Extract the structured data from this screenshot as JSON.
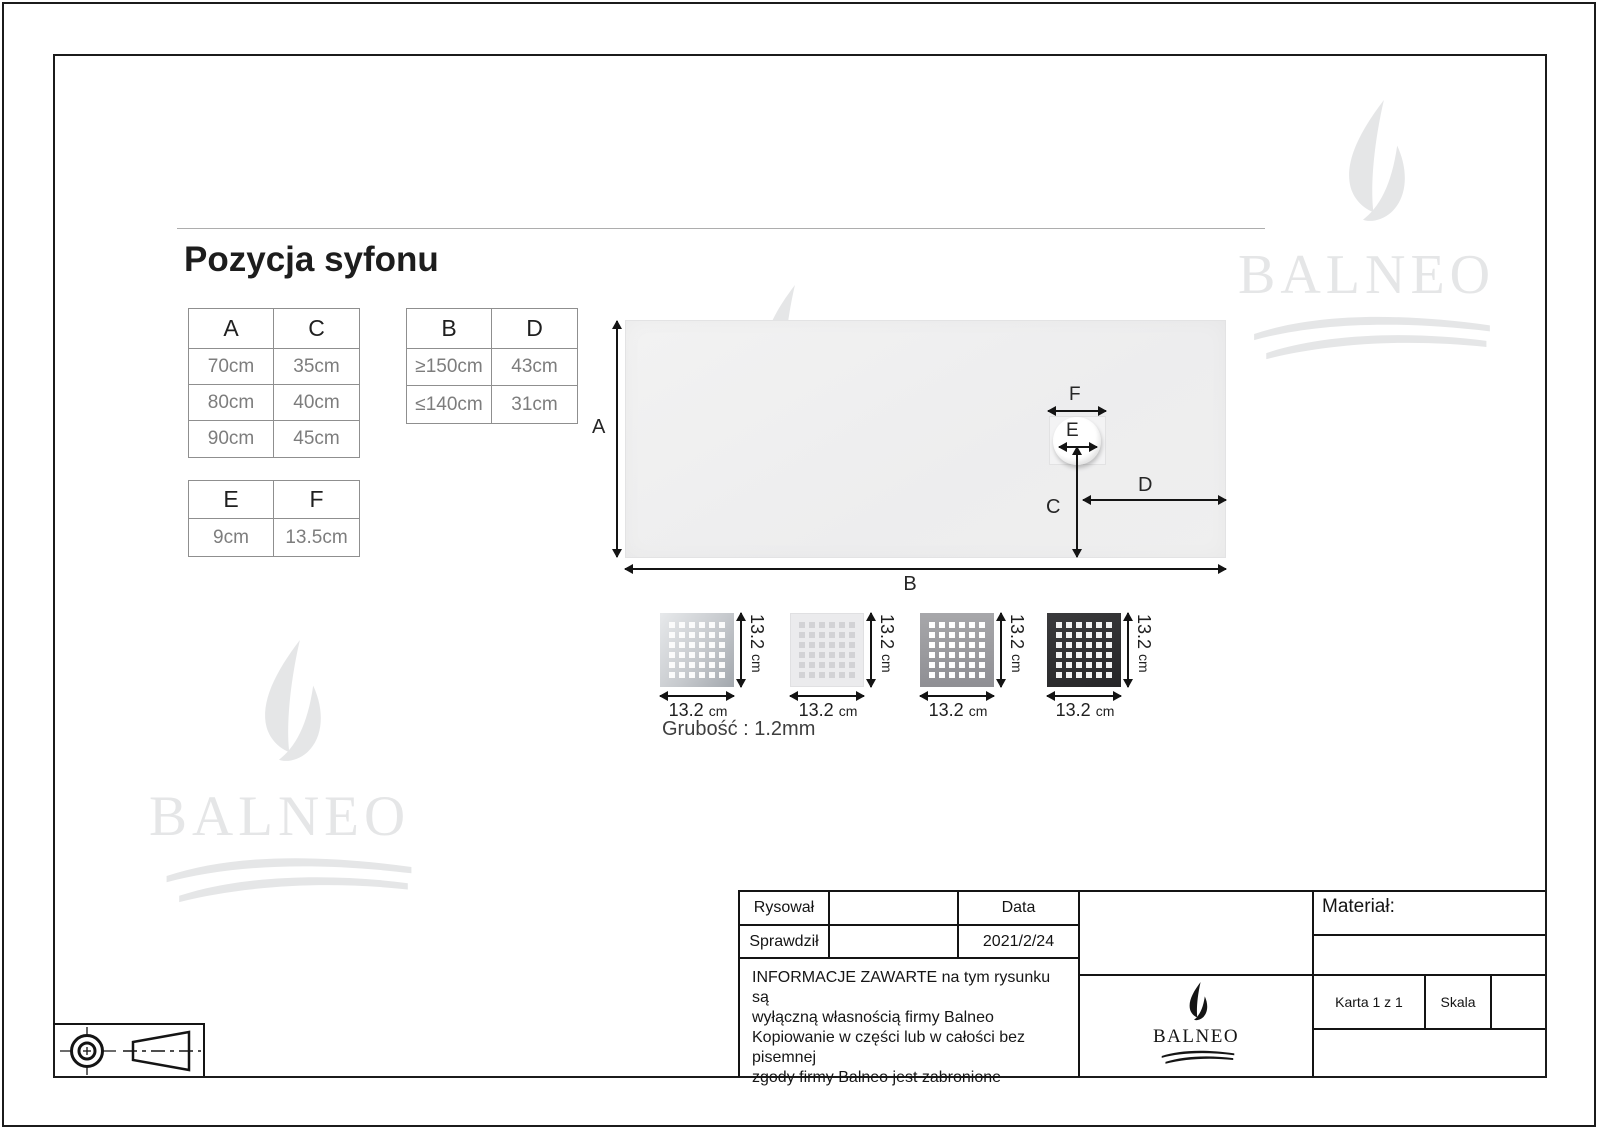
{
  "page": {
    "title": "Pozycja syfonu"
  },
  "brand": {
    "name": "BALNEO"
  },
  "tables": {
    "ac": {
      "headers": [
        "A",
        "C"
      ],
      "rows": [
        [
          "70cm",
          "35cm"
        ],
        [
          "80cm",
          "40cm"
        ],
        [
          "90cm",
          "45cm"
        ]
      ]
    },
    "bd": {
      "headers": [
        "B",
        "D"
      ],
      "rows": [
        [
          "≥150cm",
          "43cm"
        ],
        [
          "≤140cm",
          "31cm"
        ]
      ]
    },
    "ef": {
      "headers": [
        "E",
        "F"
      ],
      "rows": [
        [
          "9cm",
          "13.5cm"
        ]
      ]
    }
  },
  "diagram": {
    "dim_a": "A",
    "dim_b": "B",
    "dim_c": "C",
    "dim_d": "D",
    "dim_e": "E",
    "dim_f": "F"
  },
  "grates": {
    "dim_value": "13.2",
    "dim_unit": "cm",
    "thickness": "Grubość : 1.2mm",
    "finishes": [
      "stainless-steel",
      "white",
      "gray",
      "black"
    ]
  },
  "titleblock": {
    "drawn_label": "Rysował",
    "checked_label": "Sprawdził",
    "date_label": "Data",
    "date_value": "2021/2/24",
    "notice": "INFORMACJE ZAWARTE na tym rysunku są\nwyłączną własnością firmy Balneo\nKopiowanie w części lub w całości bez pisemnej\nzgody firmy Balneo jest zabronione",
    "material_label": "Materiał:",
    "sheet_label": "Karta 1 z 1",
    "scale_label": "Skala"
  },
  "colors": {
    "line": "#141414",
    "table_border": "#8f8f8f",
    "table_value_text": "#7d7d7d",
    "watermark": "#e5e6e7",
    "tray_fill": "#efefef",
    "grate_steel": "#c6c9cd",
    "grate_white": "#ebebed",
    "grate_gray": "#9b9b9f",
    "grate_black": "#303032"
  }
}
